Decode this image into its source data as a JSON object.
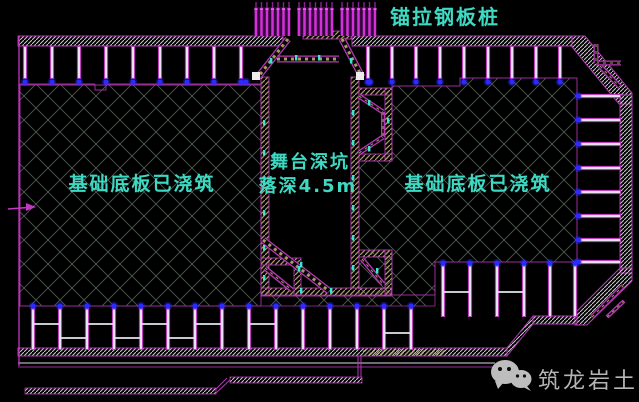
{
  "drawing": {
    "title_label": "锚拉钢板桩",
    "pit_label_line1": "舞台深坑",
    "pit_label_line2": "落深4.5m",
    "slab_left_label": "基础底板已浇筑",
    "slab_right_label": "基础底板已浇筑",
    "colors": {
      "background": "#000000",
      "label_text": "#3ed9c3",
      "magenta_outline": "#9a2d9a",
      "bright_magenta": "#d93bd9",
      "anchor_magenta": "#d42fd8",
      "pile_fill": "#e4e4ee",
      "node_blue": "#2b2bff",
      "wall_khaki": "#a89a62",
      "crosshatch_line": "#4e5a50",
      "band_hatch": "#c9c9d2",
      "tick_cyan": "#3fe3d2",
      "watermark_gray": "#b5b5b5"
    }
  },
  "watermark": {
    "icon": "wechat-icon",
    "brand_text": "筑龙岩土"
  }
}
